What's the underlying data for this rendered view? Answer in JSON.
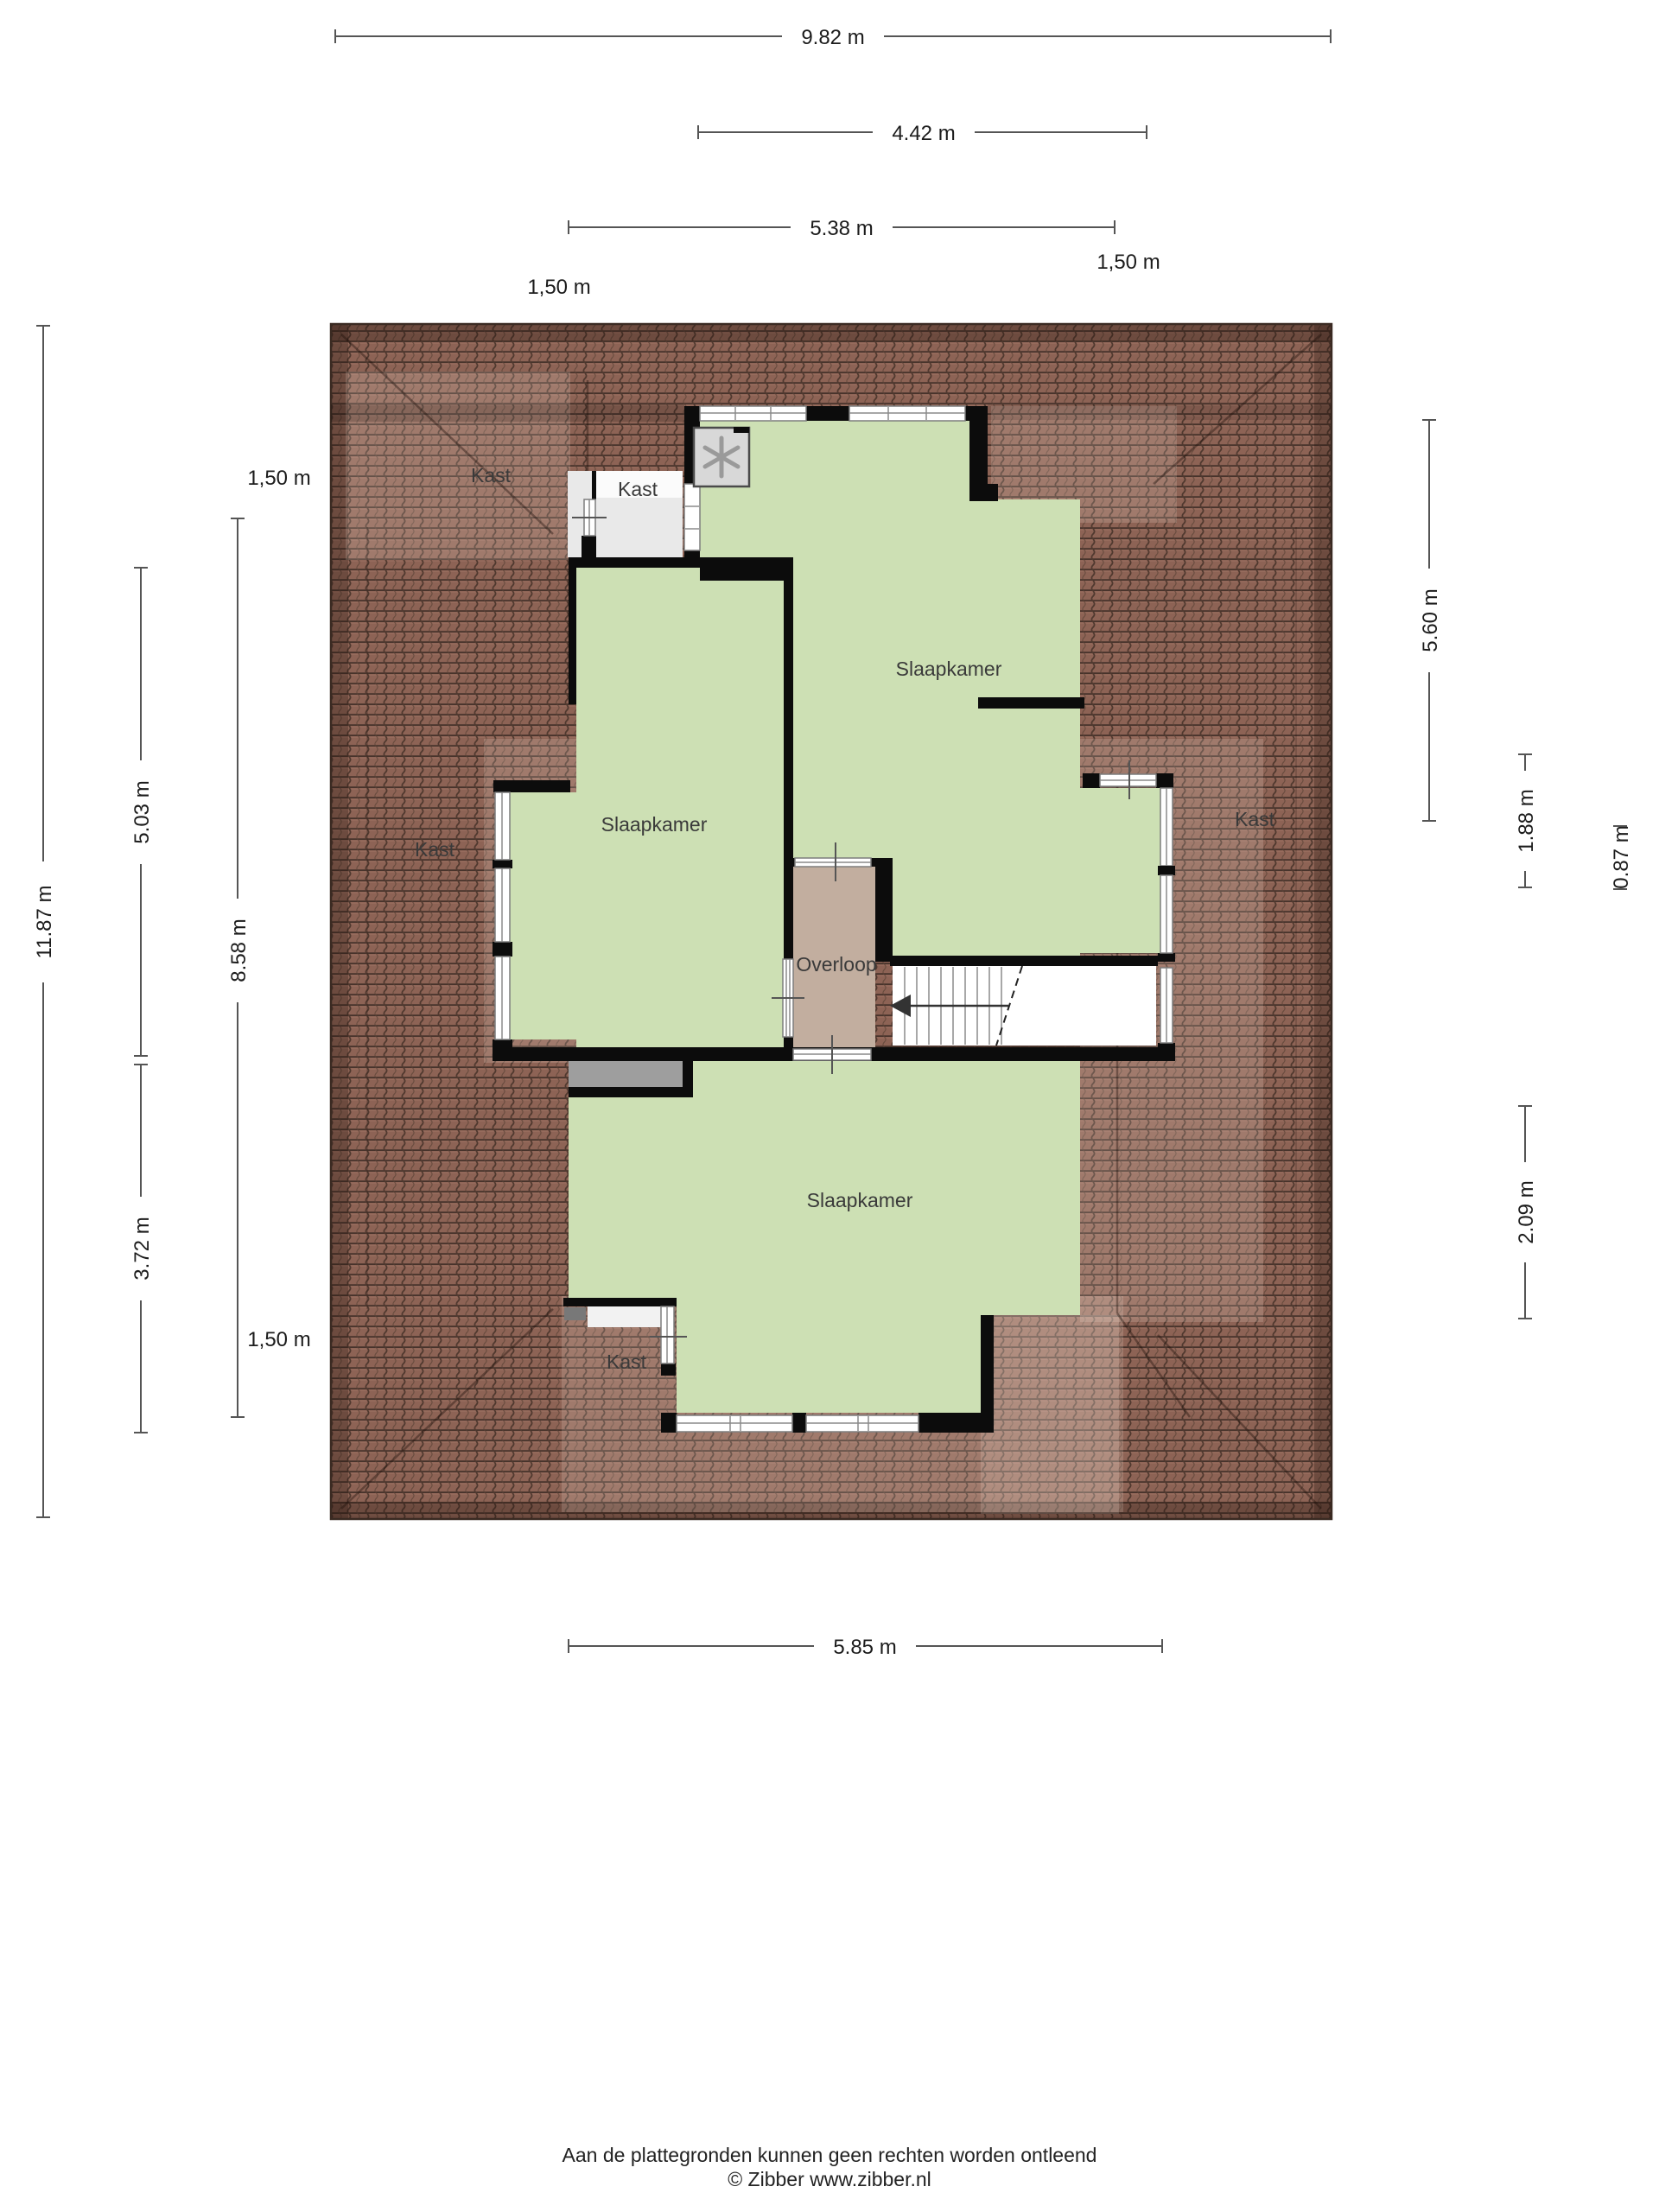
{
  "colors": {
    "room_green": "#cde0b4",
    "landing_beige": "#c2ae9f",
    "roof_base": "#8d6355",
    "roof_rib": "#50392f",
    "roof_edge": "#3a2a22",
    "wall_black": "#0c0c0c",
    "closet_floor": "#e9e9e9",
    "void_gray": "#9e9e9e",
    "stairs_white": "#ffffff",
    "dimension_line": "#555555"
  },
  "labels": {
    "bedroom_top": "Slaapkamer",
    "bedroom_left": "Slaapkamer",
    "bedroom_bottom": "Slaapkamer",
    "landing": "Overloop",
    "closet_roof_top_left": "Kast",
    "closet_top": "Kast",
    "closet_roof_left": "Kast",
    "closet_roof_right": "Kast",
    "closet_bottom_left": "Kast"
  },
  "dimensions": {
    "total_width": "9.82 m",
    "upper_width": "4.42 m",
    "mid_width": "5.38 m",
    "offset_top_right": "1,50 m",
    "offset_top_left": "1,50 m",
    "total_height": "11.87 m",
    "left_upper_height": "5.03 m",
    "left_lower_height": "3.72 m",
    "left_inner_height": "8.58 m",
    "offset_left_top": "1,50 m",
    "offset_left_bottom": "1,50 m",
    "right_height": "5.60 m",
    "right_nook_height": "1.88 m",
    "right_small_height": "0.87 m",
    "right_lower_height": "2.09 m",
    "bottom_width": "5.85 m"
  },
  "footer": {
    "disclaimer": "Aan de plattegronden kunnen geen rechten worden ontleend",
    "copyright": "© Zibber www.zibber.nl"
  }
}
